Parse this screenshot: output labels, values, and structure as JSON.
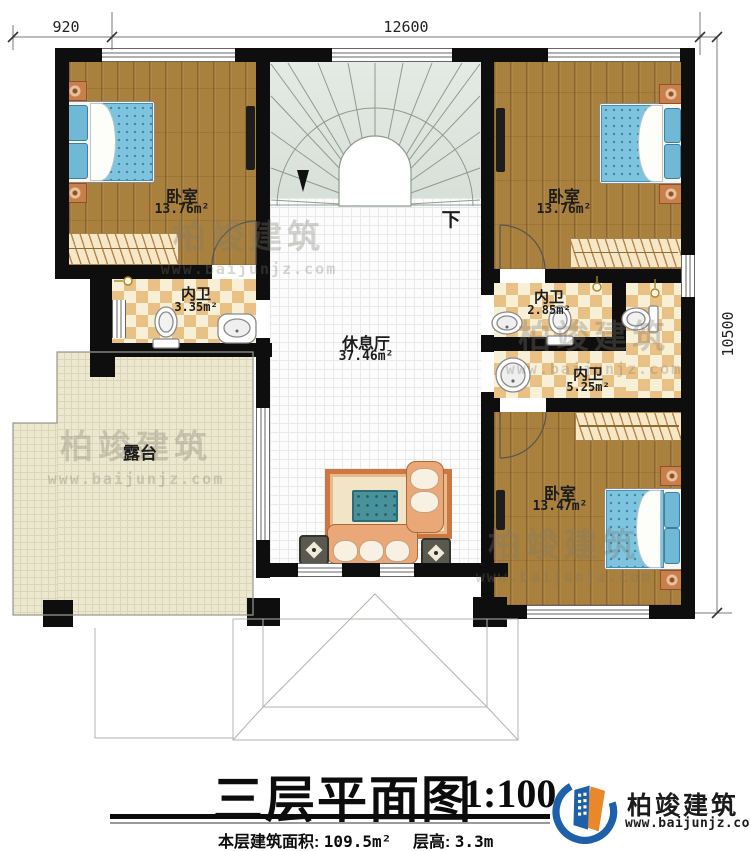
{
  "dimensions": {
    "terrace_width": "920",
    "main_width": "12600",
    "total_depth": "10500"
  },
  "rooms": {
    "bedroom_top_left": {
      "name": "卧室",
      "area": "13.76m²"
    },
    "bedroom_top_right": {
      "name": "卧室",
      "area": "13.76m²"
    },
    "bedroom_bottom_right": {
      "name": "卧室",
      "area": "13.47m²"
    },
    "bathroom_left": {
      "name": "内卫",
      "area": "3.35m²"
    },
    "bathroom_small": {
      "name": "内卫",
      "area": "2.85m²"
    },
    "bathroom_large": {
      "name": "内卫",
      "area": "5.25m²"
    },
    "hall": {
      "name": "休息厅",
      "area": "37.46m²"
    },
    "terrace": {
      "name": "露台"
    }
  },
  "stairs": {
    "direction_label": "下"
  },
  "title_block": {
    "title": "三层平面图",
    "scale": "1:100",
    "floor_area_label": "本层建筑面积:",
    "floor_area_value": "109.5m²",
    "floor_height_label": "层高:",
    "floor_height_value": "3.3m"
  },
  "brand": {
    "name": "柏竣建筑",
    "url": "www.baijunjz.com"
  },
  "watermark": {
    "name": "柏竣建筑",
    "url": "www.baijunjz.com"
  },
  "colors": {
    "wall": "#111111",
    "wood_floor": "#a9803d",
    "bath_tile": "#ecc48b",
    "stair_fill": "#dfe6df",
    "terrace_fill": "#ebe5cc",
    "bed_blue": "#7fc4de",
    "logo_blue": "#1d5fa8",
    "logo_orange": "#e8882a"
  }
}
